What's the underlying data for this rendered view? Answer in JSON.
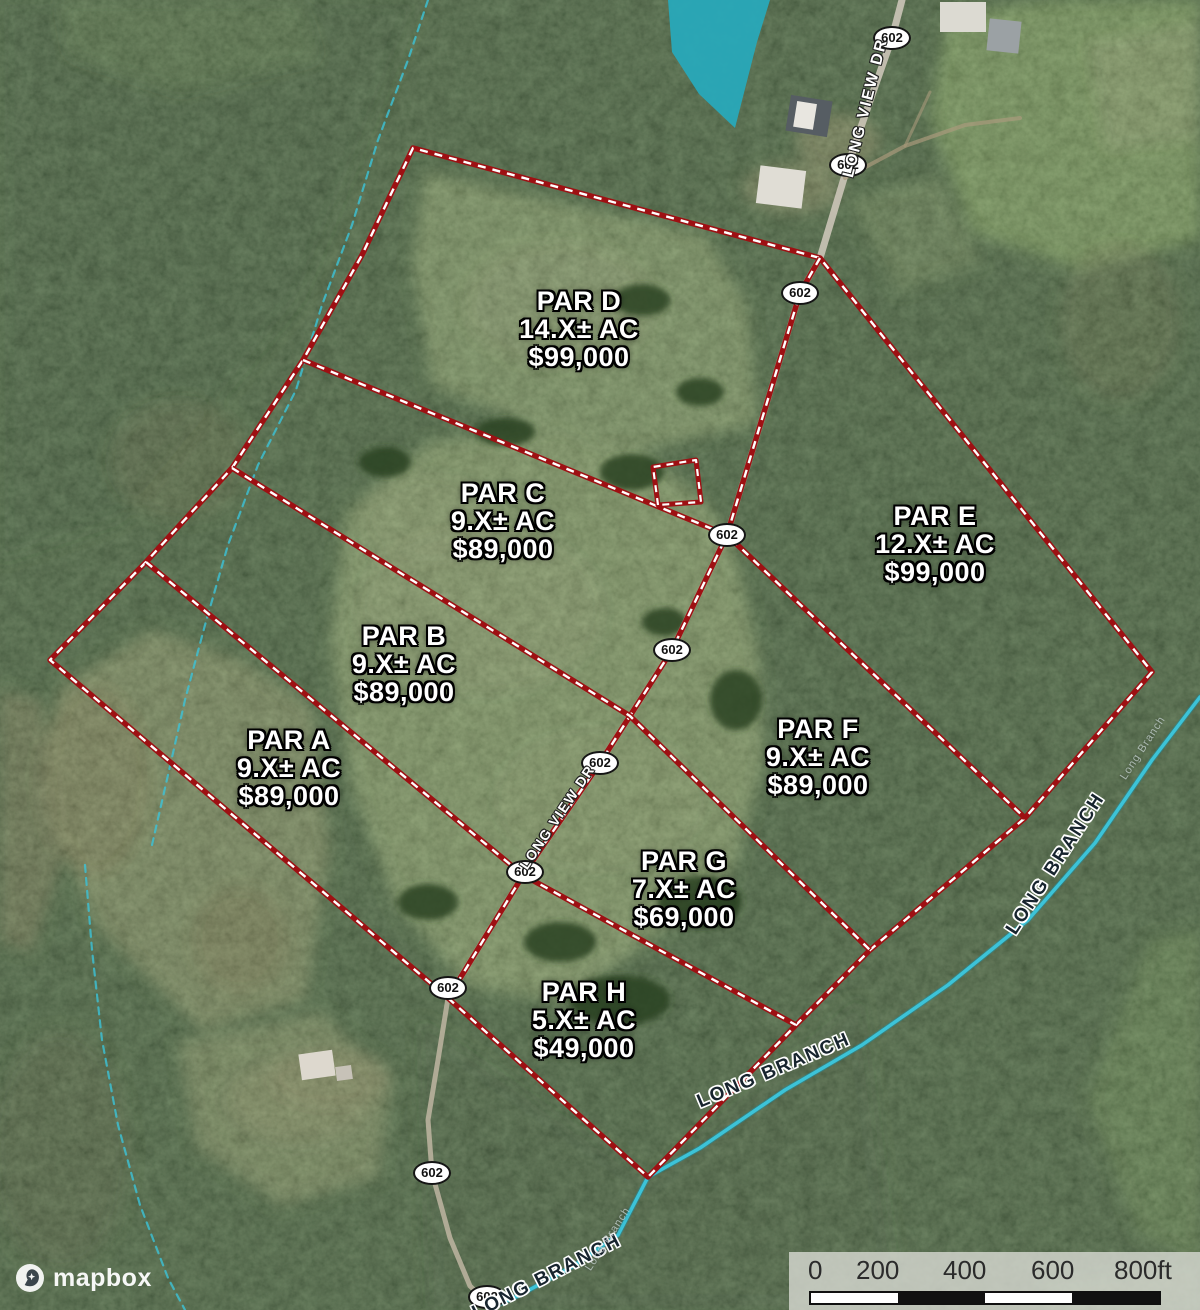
{
  "parcels": [
    {
      "name": "PAR A",
      "acreage": "9.X± AC",
      "price": "$89,000"
    },
    {
      "name": "PAR B",
      "acreage": "9.X± AC",
      "price": "$89,000"
    },
    {
      "name": "PAR C",
      "acreage": "9.X± AC",
      "price": "$89,000"
    },
    {
      "name": "PAR D",
      "acreage": "14.X± AC",
      "price": "$99,000"
    },
    {
      "name": "PAR E",
      "acreage": "12.X± AC",
      "price": "$99,000"
    },
    {
      "name": "PAR F",
      "acreage": "9.X± AC",
      "price": "$89,000"
    },
    {
      "name": "PAR G",
      "acreage": "7.X± AC",
      "price": "$69,000"
    },
    {
      "name": "PAR H",
      "acreage": "5.X± AC",
      "price": "$49,000"
    }
  ],
  "roads": {
    "route_number": "602",
    "long_view_dr": "LONG VIEW DR"
  },
  "streams": {
    "long_branch": "LONG BRANCH",
    "long_branch_small": "Long Branch"
  },
  "scale_bar": {
    "ticks": [
      "0",
      "200",
      "400",
      "600",
      "800ft"
    ]
  },
  "attribution": {
    "logo_text": "mapbox"
  },
  "colors": {
    "boundary_red": "#9e1013",
    "boundary_dash": "#ffffff",
    "stream": "#3cc3d8",
    "water_highlight": "#28a9bb"
  }
}
